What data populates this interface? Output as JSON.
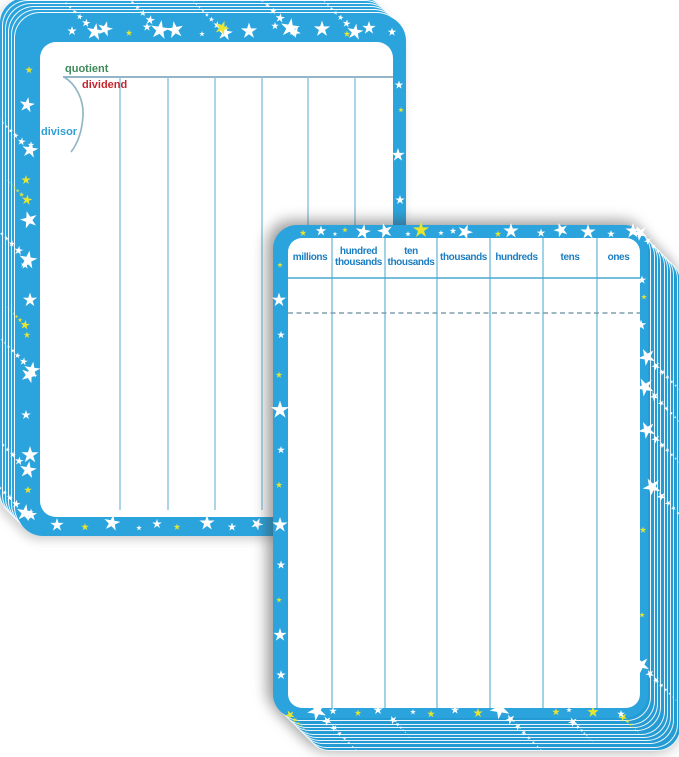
{
  "division_board": {
    "quotient_label": "quotient",
    "dividend_label": "dividend",
    "divisor_label": "divisor"
  },
  "place_value_chart": {
    "headers": [
      "millions",
      "hundred thousands",
      "ten thousands",
      "thousands",
      "hundreds",
      "tens",
      "ones"
    ]
  },
  "colors": {
    "card_blue": "#2ba4dd",
    "stack_edge_blue": "#259bd3",
    "header_text_blue": "#1b7ec2",
    "quotient_green": "#3e8a5a",
    "dividend_red": "#c4262e",
    "divisor_blue": "#2e9fd4",
    "grid_line_blue": "#8ac3dc",
    "star_white": "#ffffff",
    "star_yellow": "#e8e52f"
  }
}
